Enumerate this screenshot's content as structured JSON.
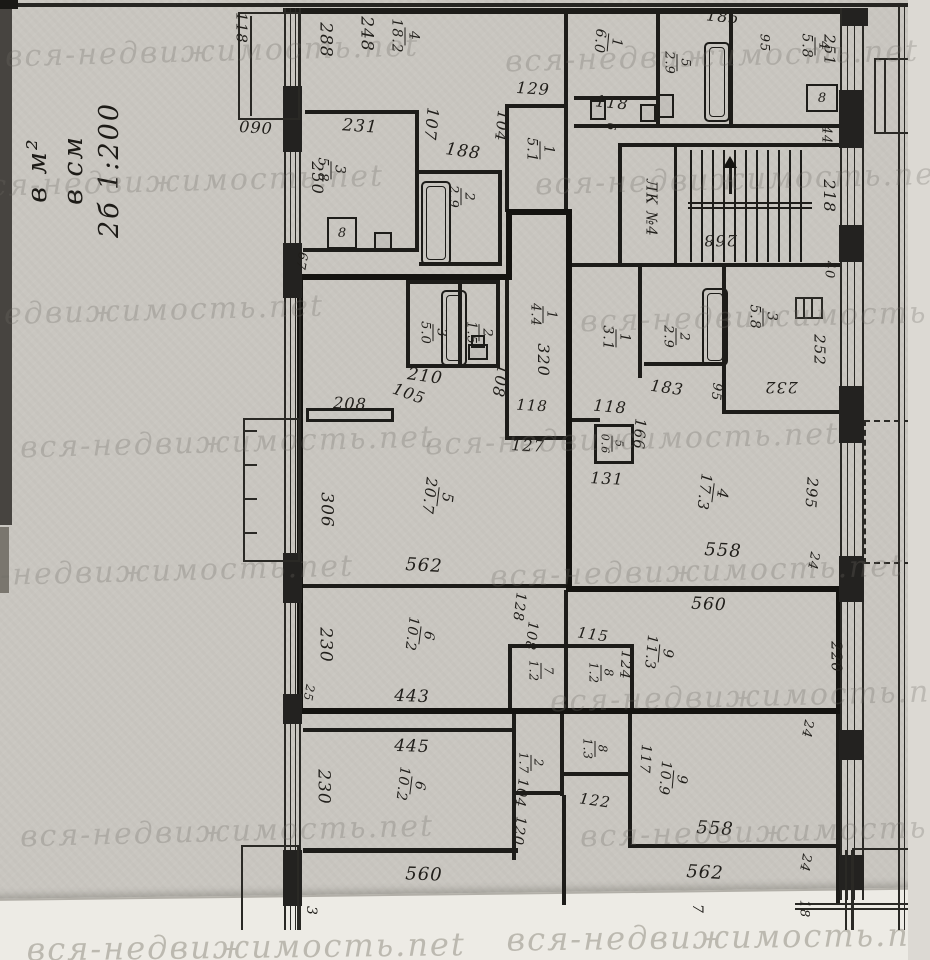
{
  "scale_note": {
    "l1": "2б 1:200",
    "l2": "в см",
    "l3": "в м²"
  },
  "watermark": {
    "text": "вся-недвижимость.net"
  },
  "stair": {
    "label": "ЛК №4"
  },
  "vents": [
    {
      "t": "8",
      "x": 327,
      "y": 217,
      "w": 26,
      "h": 28
    },
    {
      "t": "8",
      "x": 806,
      "y": 84,
      "w": 28,
      "h": 24
    }
  ],
  "labels": [
    {
      "t": "118",
      "x": 241,
      "y": 28,
      "r": 90,
      "s": 15
    },
    {
      "t": "090",
      "x": 256,
      "y": 128,
      "r": 4,
      "s": 16
    },
    {
      "t": "288",
      "x": 325,
      "y": 40,
      "r": 90,
      "s": 17
    },
    {
      "t": "248",
      "x": 366,
      "y": 34,
      "r": 90,
      "s": 17
    },
    {
      "f": [
        "4",
        "18.2"
      ],
      "x": 405,
      "y": 36,
      "r": 90,
      "s": 14
    },
    {
      "t": "231",
      "x": 360,
      "y": 127,
      "r": 4,
      "s": 17
    },
    {
      "f": [
        "3",
        "5.8"
      ],
      "x": 331,
      "y": 170,
      "r": 90,
      "s": 14
    },
    {
      "t": "250",
      "x": 317,
      "y": 178,
      "r": 90,
      "s": 16
    },
    {
      "t": "107",
      "x": 431,
      "y": 124,
      "r": 96,
      "s": 16
    },
    {
      "t": "188",
      "x": 463,
      "y": 152,
      "r": 8,
      "s": 17
    },
    {
      "f": [
        "2",
        "2.9"
      ],
      "x": 461,
      "y": 197,
      "r": 90,
      "s": 13
    },
    {
      "t": "104",
      "x": 501,
      "y": 126,
      "r": 96,
      "s": 15
    },
    {
      "t": "129",
      "x": 533,
      "y": 89,
      "r": 4,
      "s": 16
    },
    {
      "f": [
        "1",
        "5.1"
      ],
      "x": 540,
      "y": 150,
      "r": 90,
      "s": 14
    },
    {
      "t": "185",
      "x": 723,
      "y": 17,
      "r": 6,
      "s": 16
    },
    {
      "f": [
        "1",
        "6.0"
      ],
      "x": 608,
      "y": 42,
      "r": 95,
      "s": 14
    },
    {
      "t": "118",
      "x": 612,
      "y": 103,
      "r": 6,
      "s": 16
    },
    {
      "f": [
        "5",
        "2.9"
      ],
      "x": 677,
      "y": 63,
      "r": 90,
      "s": 13
    },
    {
      "t": "95",
      "x": 764,
      "y": 43,
      "r": 90,
      "s": 13
    },
    {
      "f": [
        "4",
        "5.8"
      ],
      "x": 815,
      "y": 46,
      "r": 90,
      "s": 14
    },
    {
      "t": "251",
      "x": 829,
      "y": 50,
      "r": 90,
      "s": 15
    },
    {
      "t": "44",
      "x": 826,
      "y": 135,
      "r": 90,
      "s": 13
    },
    {
      "t": "218",
      "x": 829,
      "y": 196,
      "r": 90,
      "s": 16
    },
    {
      "t": "40",
      "x": 829,
      "y": 270,
      "r": 90,
      "s": 13
    },
    {
      "t": "268",
      "x": 720,
      "y": 240,
      "r": 180,
      "s": 16
    },
    {
      "t": "6",
      "x": 611,
      "y": 127,
      "r": 90,
      "s": 12
    },
    {
      "t": "67",
      "x": 301,
      "y": 261,
      "r": 100,
      "s": 13
    },
    {
      "f": [
        "3",
        "5.0"
      ],
      "x": 433,
      "y": 333,
      "r": 90,
      "s": 13
    },
    {
      "f": [
        "2",
        "1.5"
      ],
      "x": 479,
      "y": 333,
      "r": 90,
      "s": 13
    },
    {
      "t": "210",
      "x": 425,
      "y": 377,
      "r": 8,
      "s": 17
    },
    {
      "t": "105",
      "x": 409,
      "y": 394,
      "r": 20,
      "s": 16
    },
    {
      "t": "108",
      "x": 500,
      "y": 381,
      "r": 100,
      "s": 16
    },
    {
      "t": "208",
      "x": 350,
      "y": 404,
      "r": 3,
      "s": 16
    },
    {
      "f": [
        "1",
        "4.4"
      ],
      "x": 543,
      "y": 315,
      "r": 90,
      "s": 13
    },
    {
      "t": "320",
      "x": 543,
      "y": 360,
      "r": 90,
      "s": 16
    },
    {
      "t": "118",
      "x": 532,
      "y": 406,
      "r": 3,
      "s": 15
    },
    {
      "t": "127",
      "x": 528,
      "y": 446,
      "r": 3,
      "s": 16
    },
    {
      "f": [
        "5",
        "20.7"
      ],
      "x": 438,
      "y": 497,
      "r": 97,
      "s": 15
    },
    {
      "t": "306",
      "x": 326,
      "y": 510,
      "r": 90,
      "s": 17
    },
    {
      "t": "562",
      "x": 424,
      "y": 566,
      "r": 3,
      "s": 18
    },
    {
      "f": [
        "1",
        "3.1"
      ],
      "x": 616,
      "y": 338,
      "r": 90,
      "s": 14
    },
    {
      "t": "118",
      "x": 610,
      "y": 407,
      "r": 5,
      "s": 16
    },
    {
      "f": [
        "2",
        "2.9"
      ],
      "x": 676,
      "y": 337,
      "r": 90,
      "s": 13
    },
    {
      "t": "183",
      "x": 667,
      "y": 388,
      "r": 8,
      "s": 16
    },
    {
      "t": "95",
      "x": 716,
      "y": 392,
      "r": 96,
      "s": 13
    },
    {
      "t": "166",
      "x": 639,
      "y": 434,
      "r": 94,
      "s": 15
    },
    {
      "f": [
        "5",
        "0.6"
      ],
      "x": 612,
      "y": 444,
      "r": 90,
      "s": 11
    },
    {
      "t": "131",
      "x": 607,
      "y": 479,
      "r": 3,
      "s": 16
    },
    {
      "f": [
        "3",
        "5.8"
      ],
      "x": 763,
      "y": 317,
      "r": 90,
      "s": 14
    },
    {
      "t": "232",
      "x": 781,
      "y": 387,
      "r": 180,
      "s": 16
    },
    {
      "t": "252",
      "x": 819,
      "y": 350,
      "r": 90,
      "s": 15
    },
    {
      "f": [
        "4",
        "17.3"
      ],
      "x": 713,
      "y": 493,
      "r": 97,
      "s": 15
    },
    {
      "t": "558",
      "x": 723,
      "y": 551,
      "r": 3,
      "s": 18
    },
    {
      "t": "295",
      "x": 811,
      "y": 493,
      "r": 94,
      "s": 15
    },
    {
      "t": "24",
      "x": 813,
      "y": 561,
      "r": 100,
      "s": 13
    },
    {
      "f": [
        "6",
        "10.2"
      ],
      "x": 420,
      "y": 635,
      "r": 97,
      "s": 14
    },
    {
      "t": "230",
      "x": 325,
      "y": 645,
      "r": 90,
      "s": 17
    },
    {
      "t": "443",
      "x": 412,
      "y": 697,
      "r": 2,
      "s": 17
    },
    {
      "t": "25",
      "x": 309,
      "y": 693,
      "r": 100,
      "s": 12
    },
    {
      "t": "128",
      "x": 519,
      "y": 607,
      "r": 97,
      "s": 14
    },
    {
      "t": "108",
      "x": 531,
      "y": 636,
      "r": 97,
      "s": 14
    },
    {
      "f": [
        "7",
        "1.2"
      ],
      "x": 541,
      "y": 671,
      "r": 90,
      "s": 12
    },
    {
      "t": "115",
      "x": 593,
      "y": 635,
      "r": 8,
      "s": 15
    },
    {
      "f": [
        "8",
        "1.2"
      ],
      "x": 601,
      "y": 673,
      "r": 90,
      "s": 12
    },
    {
      "t": "124",
      "x": 625,
      "y": 665,
      "r": 94,
      "s": 14
    },
    {
      "f": [
        "9",
        "11.3"
      ],
      "x": 659,
      "y": 653,
      "r": 95,
      "s": 14
    },
    {
      "t": "560",
      "x": 709,
      "y": 605,
      "r": 3,
      "s": 17
    },
    {
      "t": "220",
      "x": 836,
      "y": 657,
      "r": 90,
      "s": 15
    },
    {
      "t": "24",
      "x": 807,
      "y": 729,
      "r": 100,
      "s": 13
    },
    {
      "t": "445",
      "x": 412,
      "y": 747,
      "r": 2,
      "s": 17
    },
    {
      "f": [
        "6",
        "10.2"
      ],
      "x": 411,
      "y": 785,
      "r": 97,
      "s": 14
    },
    {
      "t": "230",
      "x": 323,
      "y": 787,
      "r": 90,
      "s": 17
    },
    {
      "t": "560",
      "x": 424,
      "y": 875,
      "r": 2,
      "s": 18
    },
    {
      "f": [
        "2",
        "1.7"
      ],
      "x": 531,
      "y": 763,
      "r": 90,
      "s": 12
    },
    {
      "t": "104",
      "x": 521,
      "y": 793,
      "r": 97,
      "s": 14
    },
    {
      "t": "120",
      "x": 519,
      "y": 831,
      "r": 97,
      "s": 14
    },
    {
      "f": [
        "8",
        "1.3"
      ],
      "x": 595,
      "y": 749,
      "r": 90,
      "s": 12
    },
    {
      "t": "122",
      "x": 595,
      "y": 801,
      "r": 8,
      "s": 15
    },
    {
      "t": "117",
      "x": 645,
      "y": 759,
      "r": 94,
      "s": 14
    },
    {
      "f": [
        "9",
        "10.9"
      ],
      "x": 673,
      "y": 779,
      "r": 95,
      "s": 14
    },
    {
      "t": "558",
      "x": 715,
      "y": 829,
      "r": 3,
      "s": 18
    },
    {
      "t": "562",
      "x": 705,
      "y": 873,
      "r": 3,
      "s": 18
    },
    {
      "t": "24",
      "x": 805,
      "y": 863,
      "r": 100,
      "s": 13
    },
    {
      "t": "18",
      "x": 804,
      "y": 909,
      "r": 90,
      "s": 13
    },
    {
      "t": "3",
      "x": 311,
      "y": 911,
      "r": 90,
      "s": 14
    },
    {
      "t": "7",
      "x": 697,
      "y": 909,
      "r": 90,
      "s": 14
    }
  ]
}
